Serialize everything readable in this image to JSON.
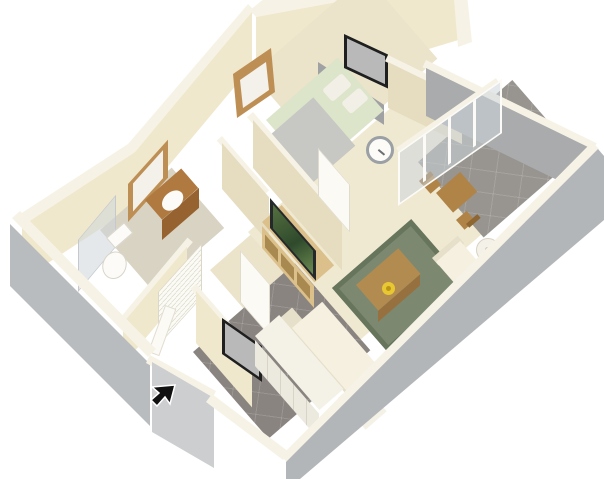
{
  "scene": {
    "type": "3d-floor-plan-render",
    "description": "Isometric dollhouse cutaway rendering of a one-bedroom apartment floor plan on a white background",
    "rooms": [
      "bedroom",
      "bathroom",
      "water-closet",
      "hallway",
      "living-room",
      "kitchen",
      "entry",
      "patio"
    ],
    "furniture": [
      "bed",
      "wall-art",
      "wall-mirror",
      "vanity-sink",
      "toilet",
      "shower-glass",
      "closet-louver-doors",
      "tv",
      "tv-stand",
      "area-rug",
      "coffee-table",
      "flower-centerpiece",
      "sectional-sofa",
      "armchair",
      "floor-lamp",
      "sliding-glass-door",
      "patio-dining-table",
      "patio-chairs",
      "kitchen-counter",
      "wall-clock",
      "entry-door",
      "entry-art"
    ]
  },
  "palette": {
    "bg": "#ffffff",
    "walltop": "#f6f3e6",
    "wallface": "#f0e8cd",
    "wallshad": "#e6ddc0",
    "extsw": "#b9bcbe",
    "extse": "#b3b6b8",
    "extcap": "#ccced0",
    "extin": "#a9abad",
    "carpet1": "#f0e9d2",
    "carpet2": "#ebe3ca",
    "bathfloor": "#d9d3c4",
    "tile": "#8a8480",
    "patiotile": "#98948f",
    "rug": "#7c8970",
    "rugborder": "#66755c",
    "sofa": "#f5f0e0",
    "sofadim": "#e6dfc9",
    "counter": "#f4f1e6",
    "cabinet": "#eceadf",
    "sheet": "#dce4ca",
    "blanket": "#c7c7c3",
    "pillow": "#f2f0e6",
    "headboard": "#9fa1a3",
    "vanity": "#b0793f",
    "vanitydark": "#96622f",
    "woodframe": "#bd8f55",
    "tvstand": "#dcc08c",
    "tvstanddark": "#c2a univers06a",
    "table": "#b28b50",
    "tabledark": "#96713f",
    "patiowood": "#b08347",
    "patiowooddark": "#8e6632",
    "tv": "#26292b",
    "frame": "#1f1f1f",
    "art": "#b9b9b9",
    "mirror": "#f3f1ea",
    "door": "#fbfaf5",
    "glass": "rgba(205,214,219,0.55)",
    "flower": "#e8c832",
    "flowercenter": "#b99416",
    "lampshade": "#f4f1e8",
    "white": "#fcfbf7",
    "clockrim": "#9aa0a4",
    "cursor": "#111111"
  },
  "cursor": {
    "visible": true,
    "shape": "arrow-northeast",
    "x": 163,
    "y": 396
  }
}
